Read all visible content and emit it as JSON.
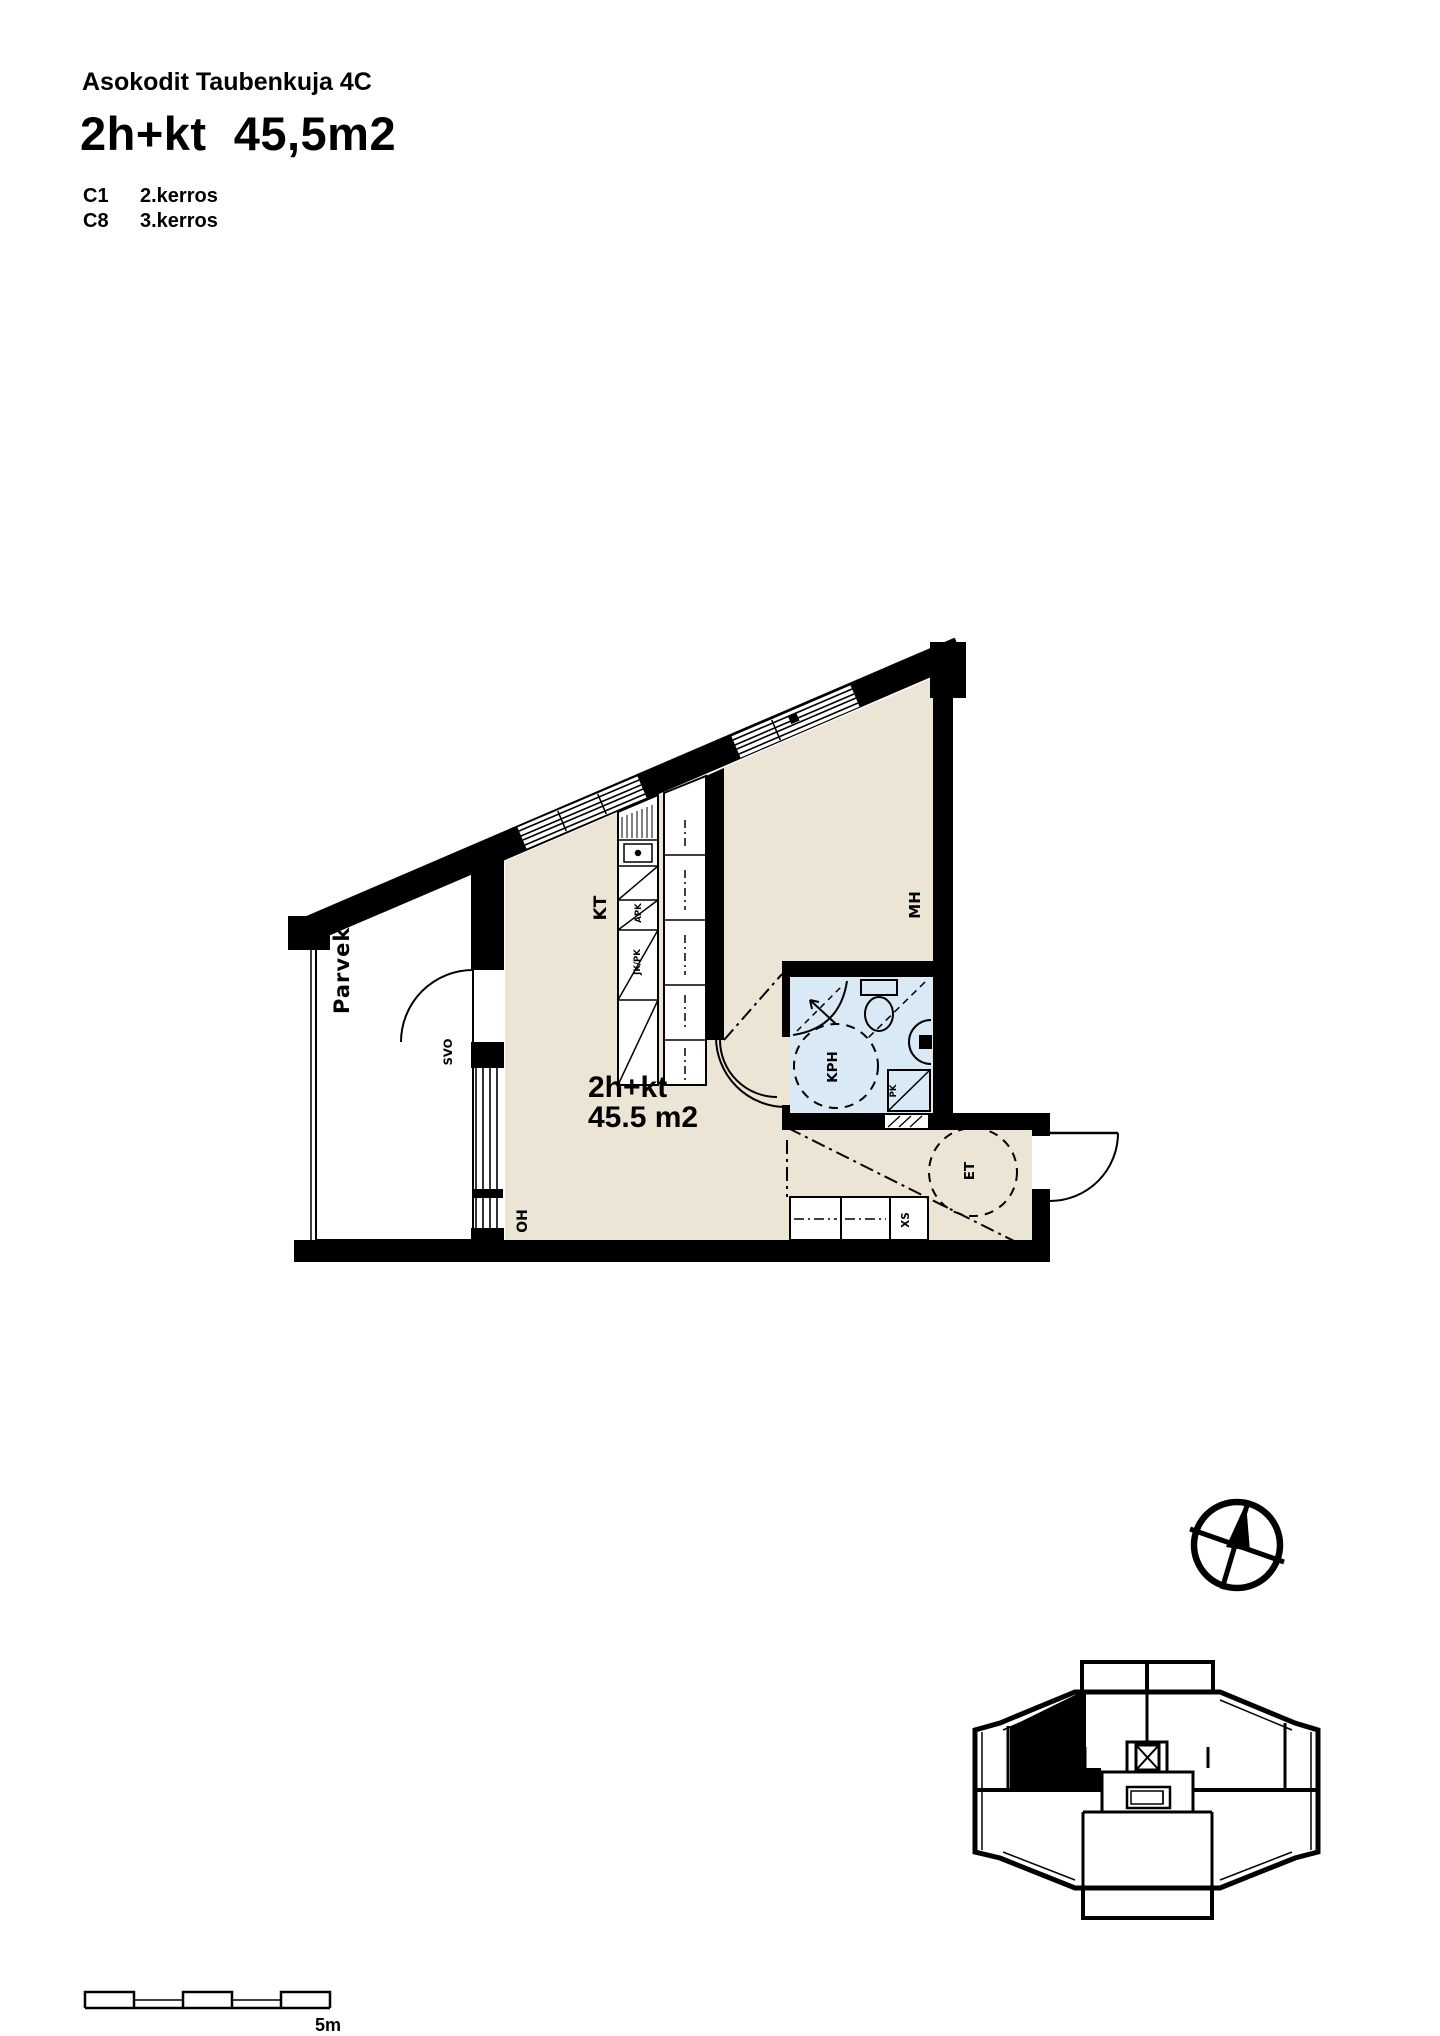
{
  "header": {
    "project_name": "Asokodit Taubenkuja 4C",
    "apartment_type": "2h+kt  45,5m2",
    "units": [
      {
        "id": "C1",
        "floor": "2.kerros"
      },
      {
        "id": "C8",
        "floor": "3.kerros"
      }
    ]
  },
  "plan": {
    "area_label": {
      "line1": "2h+kt",
      "line2": "45.5 m2"
    },
    "room_labels": {
      "balcony": "Parveke",
      "kitchen": "KT",
      "bedroom": "MH",
      "bathroom": "KPH",
      "entry": "ET",
      "living_room": "OH",
      "storage": "XS",
      "balcony_door": "SVO"
    },
    "fixture_labels": {
      "dishwasher": "APK",
      "fridge_freezer": "JK/PK",
      "washer": "PK"
    },
    "colors": {
      "floor": "#ece4d5",
      "wet_room_floor": "#d9e9f6",
      "wall": "#000000"
    }
  },
  "scale_bar": {
    "label": "5m"
  }
}
